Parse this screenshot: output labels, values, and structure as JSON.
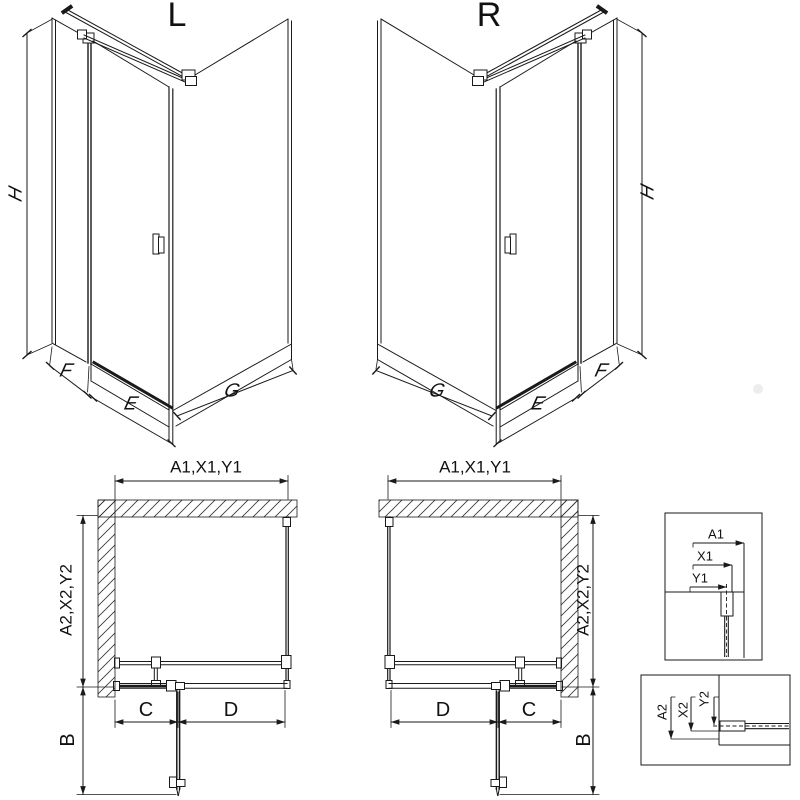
{
  "drawing": {
    "type": "shower-enclosure-technical-diagram",
    "line_color": "#1a1a1a",
    "background": "#ffffff"
  },
  "iso_l": {
    "title": "L",
    "dim_h": "H",
    "dim_f": "F",
    "dim_e": "E",
    "dim_g": "G"
  },
  "iso_r": {
    "title": "R",
    "dim_h": "H",
    "dim_f": "F",
    "dim_e": "E",
    "dim_g": "G"
  },
  "plan_l": {
    "dim_top": "A1,X1,Y1",
    "dim_side": "A2,X2,Y2",
    "dim_c": "C",
    "dim_d": "D",
    "dim_b": "B"
  },
  "plan_r": {
    "dim_top": "A1,X1,Y1",
    "dim_side": "A2,X2,Y2",
    "dim_c": "C",
    "dim_d": "D",
    "dim_b": "B"
  },
  "detail_top": {
    "dim_a1": "A1",
    "dim_x1": "X1",
    "dim_y1": "Y1"
  },
  "detail_bottom": {
    "dim_a2": "A2",
    "dim_x2": "X2",
    "dim_y2": "Y2"
  }
}
